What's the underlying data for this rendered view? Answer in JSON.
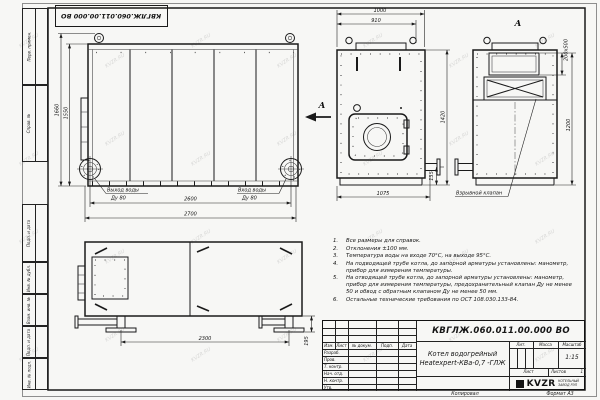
{
  "doc": {
    "number": "КВГЛЖ.060.011.00.000 ВО",
    "product_name_1": "Котел водогрейный",
    "product_name_2": "Heatexpert-КВа-0,7 -ГЛЖ"
  },
  "frame": {
    "margin_labels": [
      "Перв. примен.",
      "Справ. №",
      "Подп. и дата",
      "Инв. № дубл.",
      "Взам. инв. №",
      "Подп. и дата",
      "Инв. № подл."
    ],
    "copied": "Копировал",
    "format": "Формат А3"
  },
  "title_block": {
    "cols": {
      "izm": "Изм.",
      "list": "Лист",
      "doc": "№ докум.",
      "sign": "Подп.",
      "date": "Дата"
    },
    "rows": [
      "Разраб.",
      "Пров.",
      "Т. контр.",
      "Нач. отд.",
      "Н. контр.",
      "Утв."
    ],
    "lit": "Лит.",
    "mass": "Масса",
    "scale_label": "Масштаб",
    "scale": "1:15",
    "sheet": "Лист",
    "sheets": "Листов",
    "sheets_value": "1",
    "logo": "KVZR",
    "logo_sub1": "КОТЕЛЬНЫЙ",
    "logo_sub2": "ЗАВОД РЭП"
  },
  "notes": {
    "items": [
      {
        "n": "1.",
        "t": "Все размеры для справок."
      },
      {
        "n": "2.",
        "t": "Отклонения ±100 мм."
      },
      {
        "n": "3.",
        "t": "Температура воды на входе 70°С, на выходе 95°С."
      },
      {
        "n": "4.",
        "t": "На подводящей трубе котла, до запорной арматуры установлены: манометр, прибор для измерения температуры."
      },
      {
        "n": "5.",
        "t": "На отводящей трубе котла, до запорной арматуры установлены: манометр, прибор для измерения температуры, предохранительный клапан Ду не менее 50 и обвод с обратным клапаном Ду не менее 50 мм."
      },
      {
        "n": "6.",
        "t": "Остальные технические требования по ОСТ 108.030.133-84."
      }
    ]
  },
  "dims": {
    "side": {
      "h1": "1660",
      "h2": "1550",
      "w1": "2600",
      "w2": "2700"
    },
    "front": {
      "t1": "1000",
      "t2": "910",
      "h": "1420",
      "b": "1075",
      "f": "135"
    },
    "viewA": {
      "opening": "200х500",
      "h": "1200"
    },
    "plan": {
      "l": "2300",
      "f": "195"
    }
  },
  "labels": {
    "outlet1": "Выход воды",
    "outlet2": "Ду 80",
    "inlet1": "Вход воды",
    "inlet2": "Ду 80",
    "section": "А",
    "view_a": "А",
    "valve": "Взрывной клапан"
  },
  "watermark": "KVZR.RU"
}
